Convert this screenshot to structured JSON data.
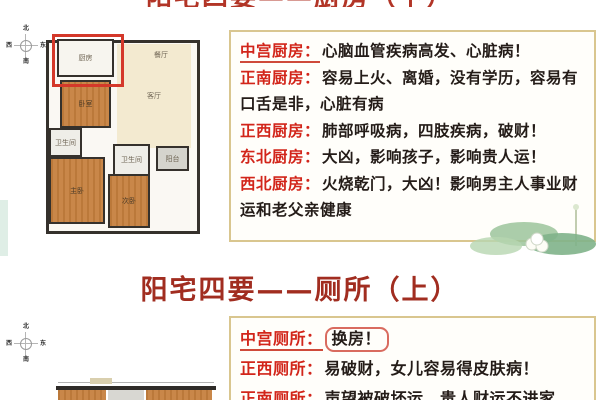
{
  "colors": {
    "label_red": "#d2251a",
    "title_red": "#a12d20",
    "highlight_red": "#d4382a",
    "panel_border_tan": "#d9c68f",
    "room_orange": "#c6813f",
    "room_cream": "#f3ead0",
    "body_text": "#241c18"
  },
  "slide1": {
    "clipped_title": "阳宅四要——厨房（下）",
    "panel": {
      "entries": [
        {
          "label": "中宫厨房：",
          "text": "心脑血管疾病高发、心脏病！"
        },
        {
          "label": "正南厨房：",
          "text": "容易上火、离婚，没有学历，容易有口舌是非，心脏有病"
        },
        {
          "label": "正西厨房：",
          "text": "肺部呼吸病，四肢疾病，破财！"
        },
        {
          "label": "东北厨房：",
          "text": "大凶，影响孩子，影响贵人运！"
        },
        {
          "label": "西北厨房：",
          "text": "火烧乾门，大凶！影响男主人事业财运和老父亲健康"
        }
      ]
    },
    "plan": {
      "labels": {
        "kitchen": "厨房",
        "dining": "餐厅",
        "living": "客厅",
        "bedroom1": "卧室",
        "bath1": "卫生间",
        "master": "主卧",
        "bath2": "卫生间",
        "balcony": "阳台",
        "bedroom2": "次卧"
      }
    },
    "compass": {
      "n": "北",
      "s": "南",
      "e": "东",
      "w": "西"
    }
  },
  "slide2": {
    "title": "阳宅四要——厕所（上）",
    "panel": {
      "entries": [
        {
          "label": "中宫厕所：",
          "text": "换房！"
        },
        {
          "label": "正西厕所：",
          "text": "易破财，女儿容易得皮肤病！"
        },
        {
          "label": "正南厕所：",
          "text": "声望被破坏运，贵人财运不进家"
        }
      ]
    },
    "compass": {
      "n": "北",
      "s": "南",
      "e": "东",
      "w": "西"
    }
  }
}
